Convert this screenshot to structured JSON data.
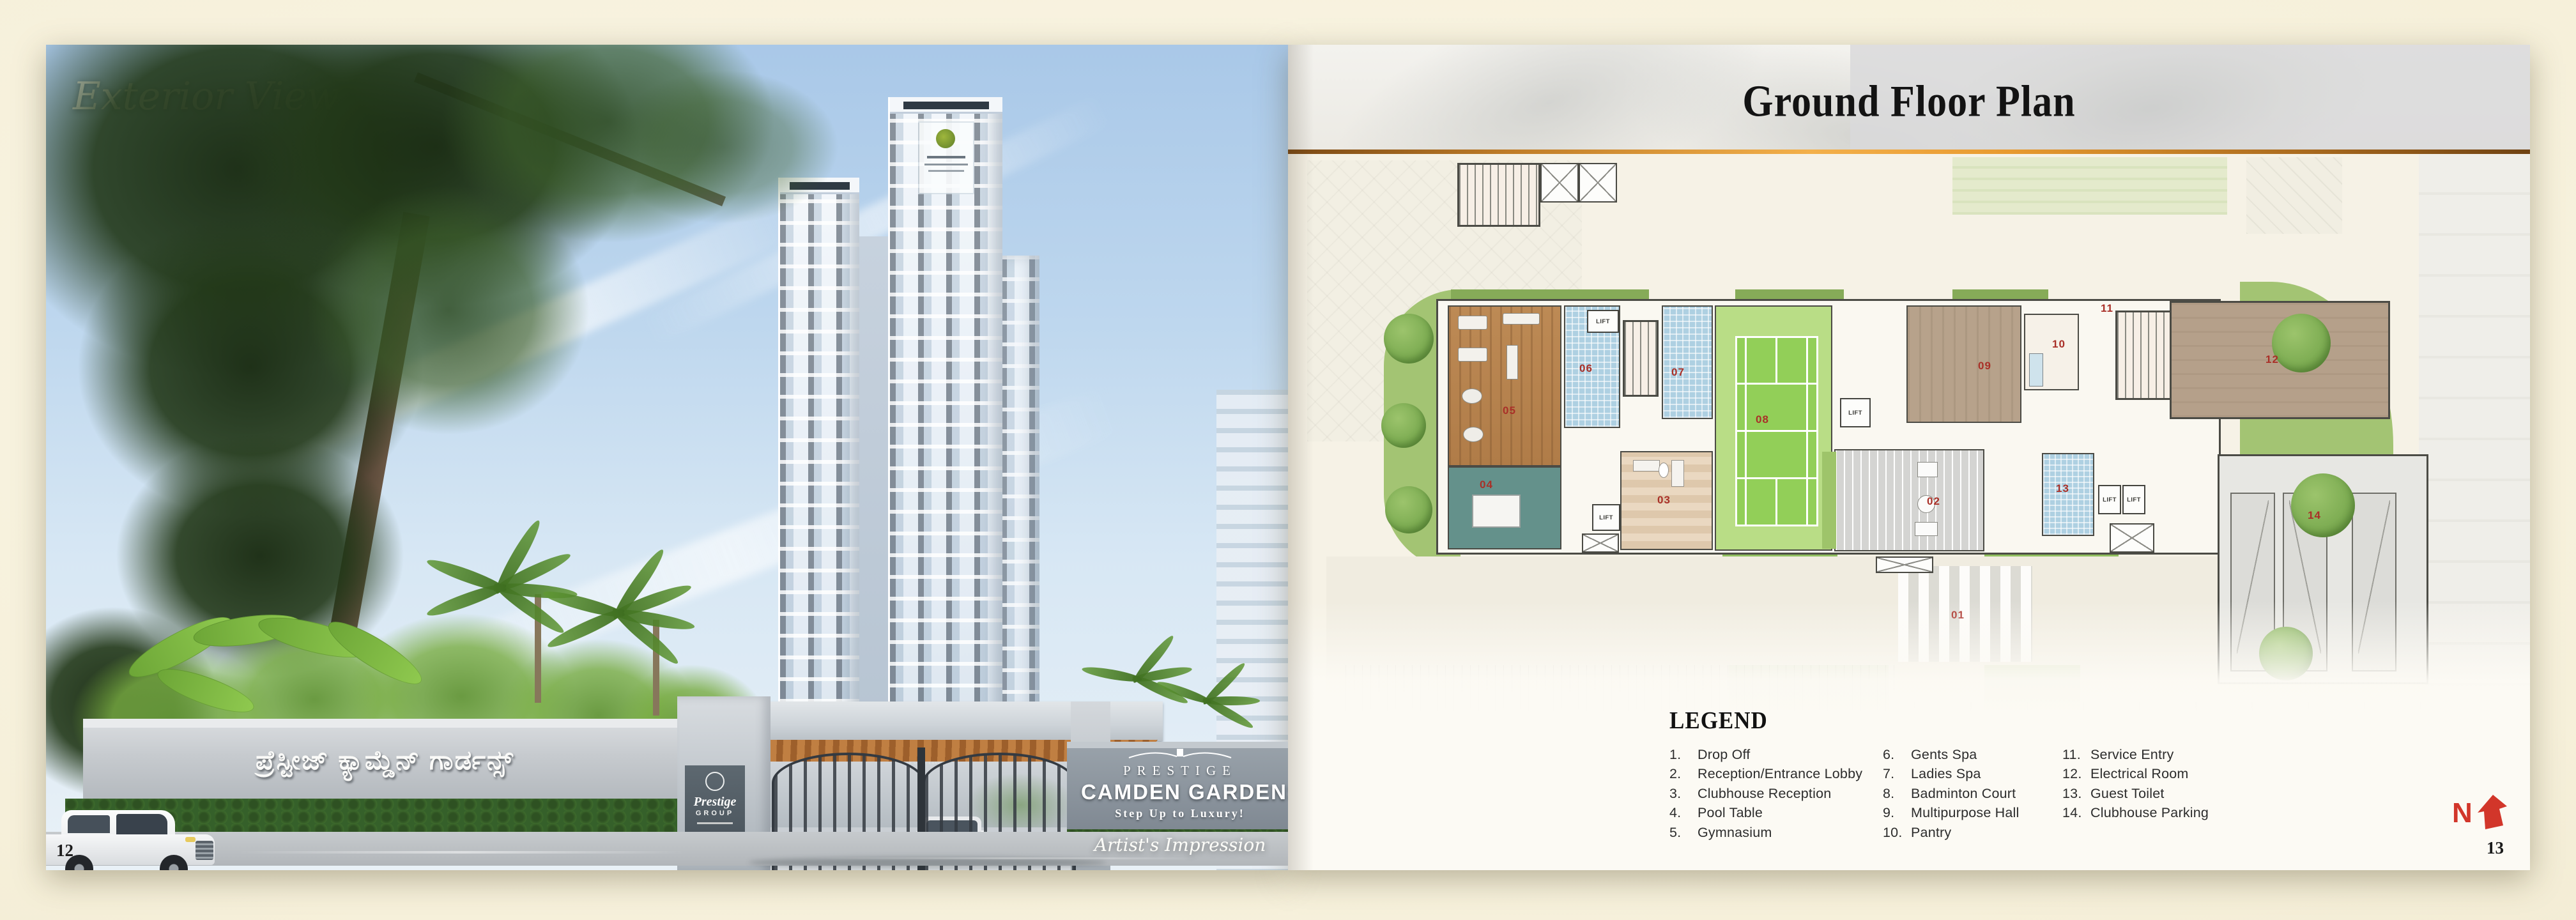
{
  "colors": {
    "background": "#f6f1dd",
    "accent_gold": "#e9a13b",
    "room_number_red": "#a93028",
    "compass_red": "#d2362a"
  },
  "left_page": {
    "title": "Exterior View",
    "page_number": "12",
    "compound_wall_sign": "ಪ್ರೆಸ್ಟೀಜ್ ಕ್ಯಾಮ್ಡೆನ್ ಗಾರ್ಡನ್ಸ್",
    "entrance_sign": {
      "brand": "PRESTIGE",
      "project": "CAMDEN GARDENS",
      "tagline": "Step Up to Luxury!"
    },
    "pillar_sign": {
      "brand": "Prestige",
      "suffix": "GROUP"
    },
    "caption": "Artist's Impression"
  },
  "right_page": {
    "title": "Ground Floor Plan",
    "page_number": "13",
    "compass": "N",
    "legend": {
      "title": "LEGEND",
      "columns": [
        [
          {
            "num": "1.",
            "label": "Drop Off"
          },
          {
            "num": "2.",
            "label": "Reception/Entrance Lobby"
          },
          {
            "num": "3.",
            "label": "Clubhouse Reception"
          },
          {
            "num": "4.",
            "label": "Pool Table"
          },
          {
            "num": "5.",
            "label": "Gymnasium"
          }
        ],
        [
          {
            "num": "6.",
            "label": "Gents Spa"
          },
          {
            "num": "7.",
            "label": "Ladies Spa"
          },
          {
            "num": "8.",
            "label": "Badminton Court"
          },
          {
            "num": "9.",
            "label": "Multipurpose Hall"
          },
          {
            "num": "10.",
            "label": "Pantry"
          }
        ],
        [
          {
            "num": "11.",
            "label": "Service Entry"
          },
          {
            "num": "12.",
            "label": "Electrical Room"
          },
          {
            "num": "13.",
            "label": "Guest Toilet"
          },
          {
            "num": "14.",
            "label": "Clubhouse Parking"
          }
        ]
      ]
    },
    "plan": {
      "lift_label": "LIFT",
      "labels": {
        "n01": "01",
        "n02": "02",
        "n03": "03",
        "n04": "04",
        "n05": "05",
        "n06": "06",
        "n07": "07",
        "n08": "08",
        "n09": "09",
        "n10": "10",
        "n11": "11",
        "n12": "12",
        "n13": "13",
        "n14": "14"
      }
    }
  }
}
